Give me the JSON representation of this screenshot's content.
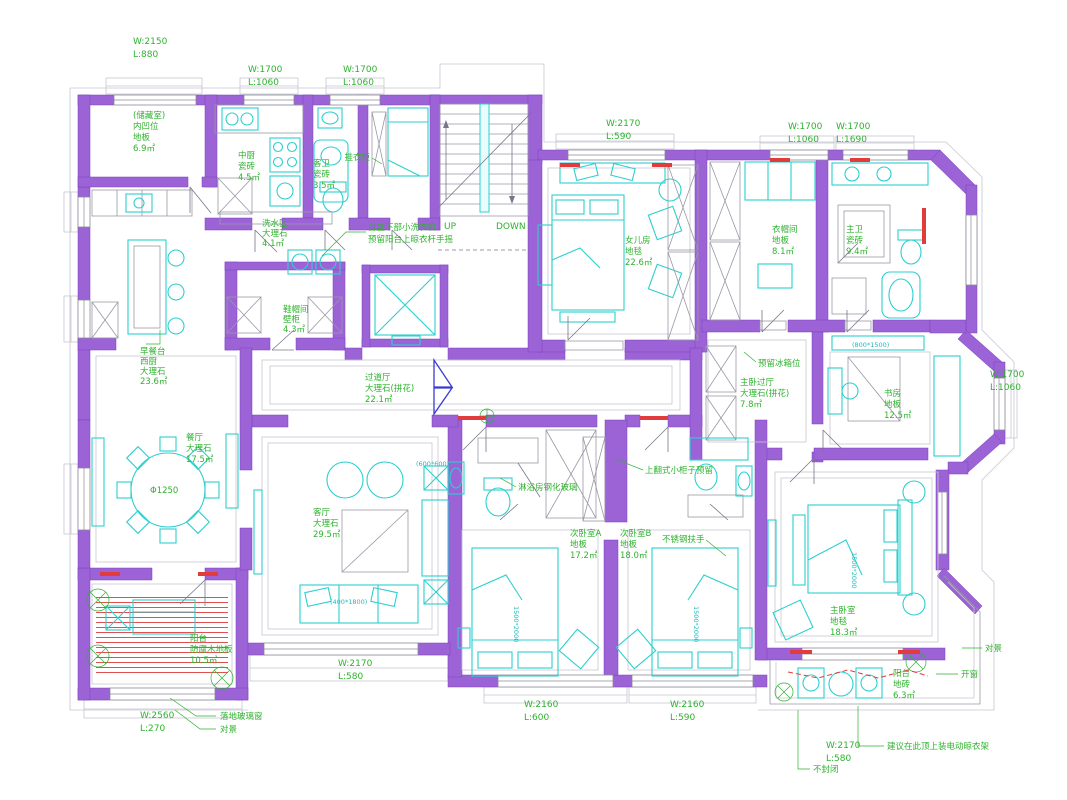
{
  "drawing_type": "residential-floor-plan",
  "colors": {
    "wall": "#9c63d6",
    "furniture": "#2ccfcf",
    "label": "#2eb22e",
    "accent_red": "#e23b3b",
    "threshold_tan": "#b49a4a",
    "door_leaf": "#3b3bd0"
  },
  "stair": {
    "up": "UP",
    "down": "DOWN"
  },
  "rooms": {
    "storage": {
      "l1": "(储藏室)",
      "l2": "内凹位",
      "l3": "地板",
      "l4": "6.9㎡"
    },
    "kitchen": {
      "l1": "中厨",
      "l2": "瓷砖",
      "l3": "4.5㎡"
    },
    "guestbath": {
      "l1": "客卫",
      "l2": "瓷砖",
      "l3": "3.5㎡"
    },
    "laundry": {
      "l1": "洗水区",
      "l2": "大理石",
      "l3": "4.1㎡"
    },
    "closet": {
      "l1": "鞋帽间",
      "l2": "壁柜",
      "l3": "4.3㎡"
    },
    "westkitchen": {
      "l1": "早餐台",
      "l2": "西厨",
      "l3": "大理石",
      "l4": "23.6㎡"
    },
    "corridor": {
      "l1": "过道厅",
      "l2": "大理石(拼花)",
      "l3": "22.1㎡"
    },
    "dining": {
      "l1": "餐厅",
      "l2": "大理石",
      "l3": "17.5㎡"
    },
    "living": {
      "l1": "客厅",
      "l2": "大理石",
      "l3": "29.5㎡"
    },
    "daughter": {
      "l1": "女儿房",
      "l2": "地毯",
      "l3": "22.6㎡"
    },
    "cloak": {
      "l1": "衣帽间",
      "l2": "地板",
      "l3": "8.1㎡"
    },
    "masterbath": {
      "l1": "主卫",
      "l2": "瓷砖",
      "l3": "9.4㎡"
    },
    "masterhall": {
      "l1": "主卧过厅",
      "l2": "大理石(拼花)",
      "l3": "7.8㎡"
    },
    "study": {
      "l1": "书房",
      "l2": "地板",
      "l3": "12.5㎡"
    },
    "masterbed": {
      "l1": "主卧室",
      "l2": "地毯",
      "l3": "18.3㎡"
    },
    "bedrooma": {
      "l1": "次卧室A",
      "l2": "地板",
      "l3": "17.2㎡"
    },
    "bedroomb": {
      "l1": "次卧室B",
      "l2": "地板",
      "l3": "18.0㎡"
    },
    "balconysw": {
      "l1": "阳台",
      "l2": "防腐木地板",
      "l3": "10.5㎡"
    },
    "balconyse": {
      "l1": "阳台",
      "l2": "地砖",
      "l3": "6.3㎡"
    }
  },
  "dims": {
    "d1": {
      "w": "W:2150",
      "l": "L:880"
    },
    "d2": {
      "w": "W:1700",
      "l": "L:1060"
    },
    "d3": {
      "w": "W:1700",
      "l": "L:1060"
    },
    "d4": {
      "w": "W:2170",
      "l": "L:590"
    },
    "d5": {
      "w": "W:1700",
      "l": "L:1060"
    },
    "d6": {
      "w": "W:1700",
      "l": "L:1690"
    },
    "d7": {
      "w": "W:1700",
      "l": "L:1060"
    },
    "d8": {
      "w": "W:2170",
      "l": "L:580"
    },
    "d9": {
      "w": "W:2160",
      "l": "L:600"
    },
    "d10": {
      "w": "W:2160",
      "l": "L:590"
    },
    "d11": {
      "w": "W:2560",
      "l": "L:270"
    },
    "d12": {
      "w": "W:2170",
      "l": "L:580"
    }
  },
  "notes": {
    "laundry1": "台盆下部小洗衣机",
    "laundry2": "预留阳台上晾衣杆手摇",
    "wardrobe": "挂衣柜",
    "fridge": "预留冰箱位",
    "flipcab": "上翻式小柜子预留",
    "showerglass": "淋浴房钢化玻璃",
    "rail": "不锈钢扶手",
    "openwin": "开窗",
    "dryrack": "建议在此顶上装电动晾衣架",
    "unclosed": "不封闭",
    "glasswin": "落地玻璃窗",
    "view1": "对景",
    "view2": "对景",
    "table_dia": "Φ1250"
  },
  "tags": {
    "bed": "1500*2000",
    "sofa": "(400*1800)",
    "sidetable": "(600*600)",
    "studybench": "(800*1500)"
  }
}
